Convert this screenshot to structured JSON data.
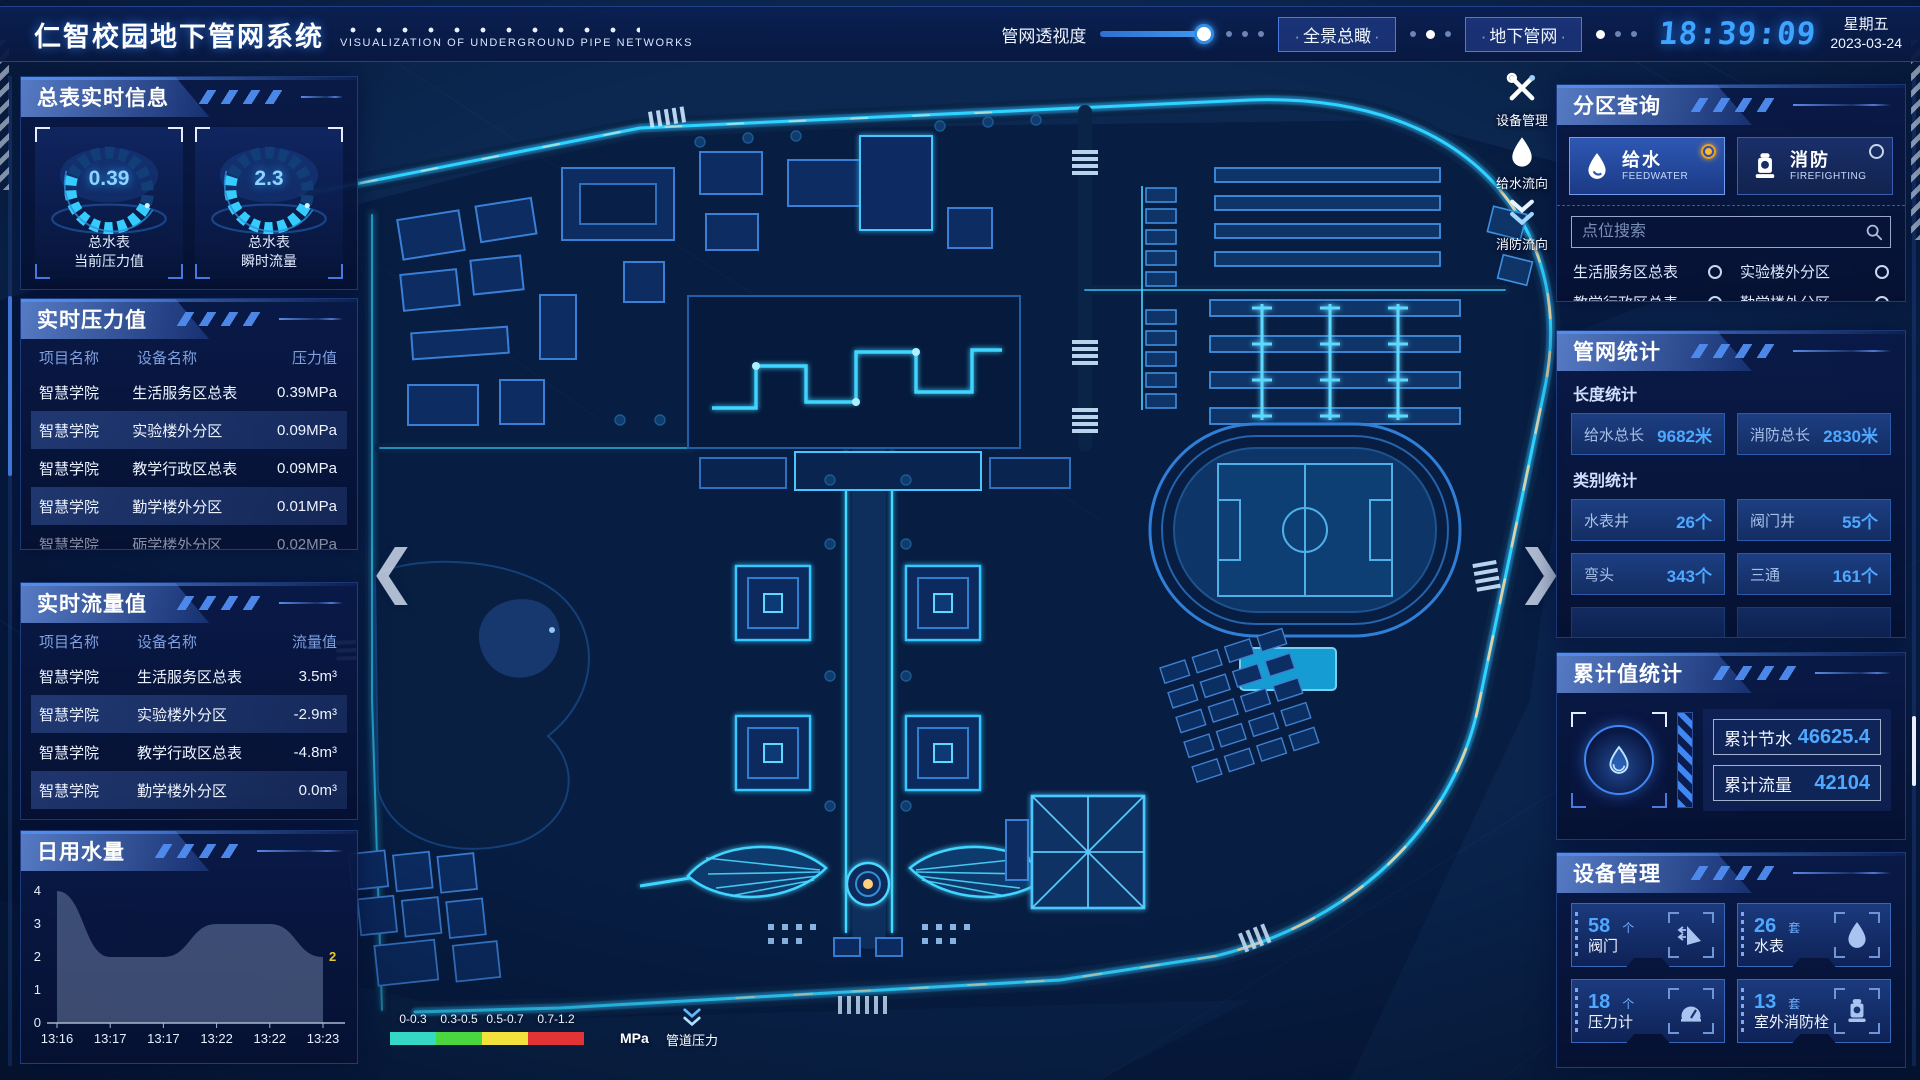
{
  "header": {
    "title": "仁智校园地下管网系统",
    "subtitle": "VISUALIZATION OF UNDERGROUND PIPE NETWORKS",
    "opacity_label": "管网透视度",
    "btn_overview": "全景总瞰",
    "btn_underground": "地下管网",
    "time": "18:39:09",
    "weekday": "星期五",
    "date": "2023-03-24"
  },
  "left": {
    "meters": {
      "title": "总表实时信息",
      "gauges": [
        {
          "value": "0.39",
          "line1": "总水表",
          "line2": "当前压力值"
        },
        {
          "value": "2.3",
          "line1": "总水表",
          "line2": "瞬时流量"
        }
      ]
    },
    "pressure": {
      "title": "实时压力值",
      "columns": [
        "项目名称",
        "设备名称",
        "压力值"
      ],
      "rows": [
        [
          "智慧学院",
          "生活服务区总表",
          "0.39MPa"
        ],
        [
          "智慧学院",
          "实验楼外分区",
          "0.09MPa"
        ],
        [
          "智慧学院",
          "教学行政区总表",
          "0.09MPa"
        ],
        [
          "智慧学院",
          "勤学楼外分区",
          "0.01MPa"
        ],
        [
          "智慧学院",
          "砺学楼外分区",
          "0.02MPa"
        ]
      ]
    },
    "flow": {
      "title": "实时流量值",
      "columns": [
        "项目名称",
        "设备名称",
        "流量值"
      ],
      "rows": [
        [
          "智慧学院",
          "生活服务区总表",
          "3.5m³"
        ],
        [
          "智慧学院",
          "实验楼外分区",
          "-2.9m³"
        ],
        [
          "智慧学院",
          "教学行政区总表",
          "-4.8m³"
        ],
        [
          "智慧学院",
          "勤学楼外分区",
          "0.0m³"
        ],
        [
          "智慧学院",
          "砺学楼外分区",
          "2.3m³"
        ]
      ]
    },
    "daily": {
      "title": "日用水量"
    }
  },
  "chart_data": {
    "type": "area",
    "title": "日用水量",
    "x": [
      "13:16",
      "13:17",
      "13:17",
      "13:22",
      "13:22",
      "13:23"
    ],
    "values": [
      4,
      2,
      2,
      3,
      3,
      2
    ],
    "end_label": "2",
    "ylim": [
      0,
      4
    ],
    "yticks": [
      0,
      1,
      2,
      3,
      4
    ],
    "grid": false,
    "area_color": "rgba(148,168,204,0.38)",
    "end_label_color": "#e8c832"
  },
  "map": {
    "tools": [
      {
        "label": "设备管理",
        "icon": "tools-icon"
      },
      {
        "label": "给水流向",
        "icon": "waterdrop-icon"
      },
      {
        "label": "消防流向",
        "icon": "flow-down-icon"
      }
    ],
    "legend": {
      "ranges": [
        "0-0.3",
        "0.3-0.5",
        "0.5-0.7",
        "0.7-1.2"
      ],
      "colors": [
        "#35d8c5",
        "#4ad63e",
        "#f2e23b",
        "#e23434"
      ],
      "widths": [
        46,
        46,
        46,
        56
      ],
      "unit": "MPa",
      "pressure_label": "管道压力"
    }
  },
  "right": {
    "query": {
      "title": "分区查询",
      "modes": [
        {
          "label": "给水",
          "sub": "FEEDWATER",
          "active": true
        },
        {
          "label": "消防",
          "sub": "FIREFIGHTING",
          "active": false
        }
      ],
      "search_placeholder": "点位搜索",
      "points": [
        "生活服务区总表",
        "实验楼外分区",
        "教学行政区总表",
        "勤学楼外分区",
        "砺学楼外分区",
        "宿舍区泵房"
      ]
    },
    "stats": {
      "title": "管网统计",
      "length_title": "长度统计",
      "length": [
        {
          "label": "给水总长",
          "value": "9682米"
        },
        {
          "label": "消防总长",
          "value": "2830米"
        }
      ],
      "category_title": "类别统计",
      "category": [
        {
          "label": "水表井",
          "value": "26个"
        },
        {
          "label": "阀门井",
          "value": "55个"
        },
        {
          "label": "弯头",
          "value": "343个"
        },
        {
          "label": "三通",
          "value": "161个"
        }
      ]
    },
    "totals": {
      "title": "累计值统计",
      "rows": [
        {
          "label": "累计节水",
          "value": "46625.4"
        },
        {
          "label": "累计流量",
          "value": "42104"
        }
      ]
    },
    "devices": {
      "title": "设备管理",
      "cards": [
        {
          "count": "58",
          "unit": "个",
          "label": "阀门",
          "icon": "valve-icon"
        },
        {
          "count": "26",
          "unit": "套",
          "label": "水表",
          "icon": "water-meter-icon"
        },
        {
          "count": "18",
          "unit": "个",
          "label": "压力计",
          "icon": "pressure-gauge-icon"
        },
        {
          "count": "13",
          "unit": "套",
          "label": "室外消防栓",
          "icon": "hydrant-icon"
        }
      ]
    }
  }
}
